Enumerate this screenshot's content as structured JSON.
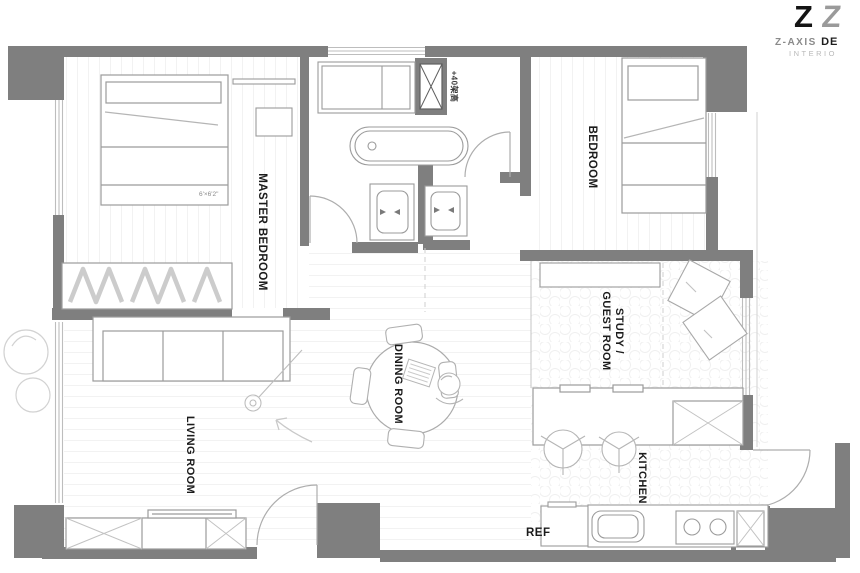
{
  "logo": {
    "mark1": "Z",
    "mark2": "Z",
    "brand": "Z-AXIS",
    "brand_bold": "DE",
    "subtitle": "INTERIO"
  },
  "rooms": {
    "master_bedroom": "MASTER BEDROOM",
    "bedroom": "BEDROOM",
    "study_line1": "STUDY /",
    "study_line2": "GUEST ROOM",
    "dining": "DINING ROOM",
    "living": "LIVING ROOM",
    "kitchen": "KITCHEN"
  },
  "annotations": {
    "fridge": "REF",
    "raised_floor": "+40架高",
    "bed_size": "6'×6'2\""
  },
  "palette": {
    "wall": "#7f7f7f",
    "furniture_line": "#9b9b9b",
    "window_line": "#bdbdbd",
    "sketch_line": "#c9c9c9",
    "label_color": "#1b1b1b"
  }
}
